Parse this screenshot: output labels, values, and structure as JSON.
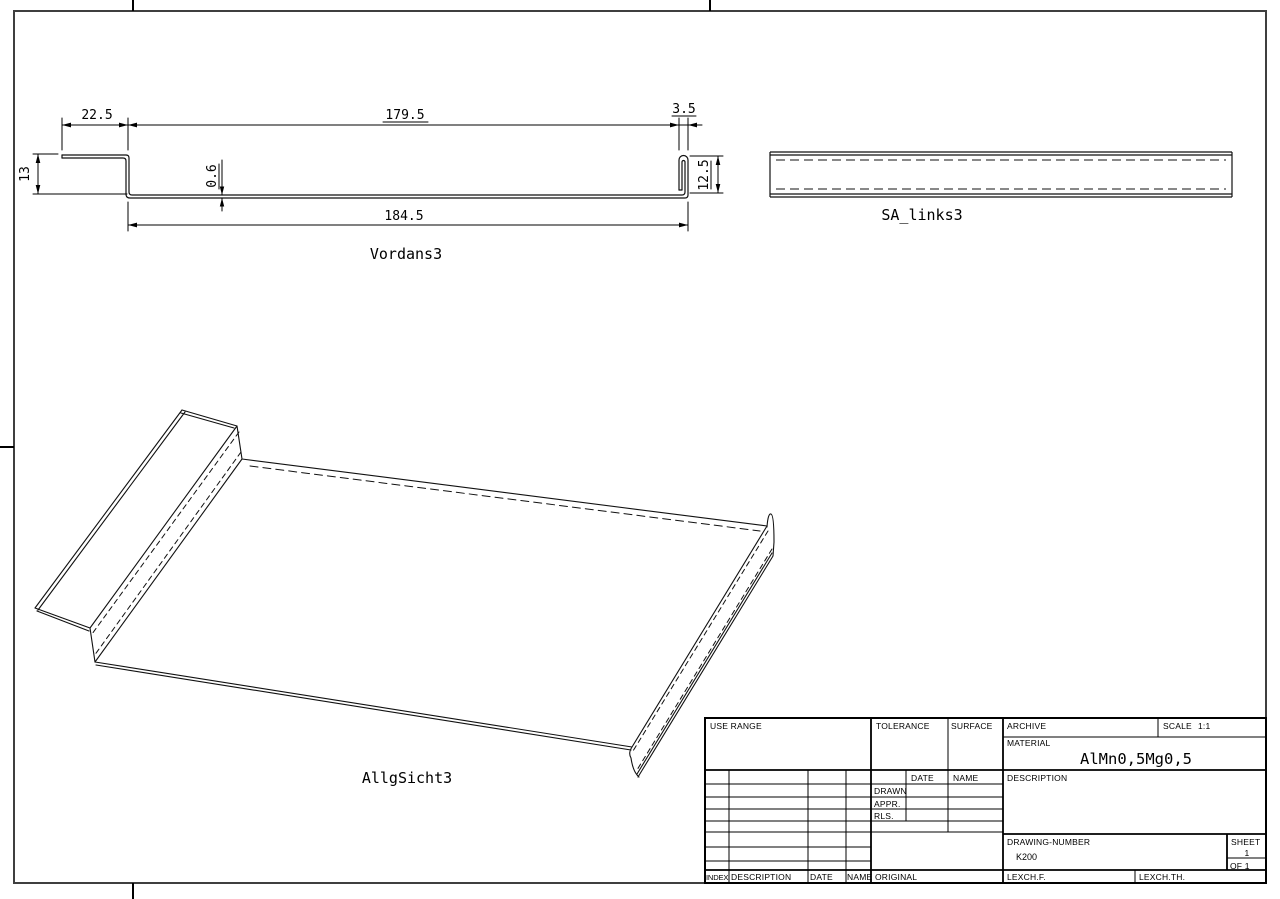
{
  "page": {
    "background": "#ffffff",
    "line_color": "#000000",
    "border_color": "#3f3f3f"
  },
  "views": {
    "front": {
      "label": "Vordans3",
      "dims": {
        "flange_width": "22.5",
        "top_length": "179.5",
        "hem_width": "3.5",
        "base_length": "184.5",
        "left_height": "13",
        "thickness": "0.6",
        "right_height": "12.5"
      }
    },
    "side": {
      "label": "SA_links3"
    },
    "iso": {
      "label": "AllgSicht3"
    }
  },
  "title_block": {
    "use_range": "USE RANGE",
    "tolerance": "TOLERANCE",
    "surface": "SURFACE",
    "archive": "ARCHIVE",
    "scale_label": "SCALE",
    "scale_value": "1:1",
    "material_label": "MATERIAL",
    "material_value": "AlMn0,5Mg0,5",
    "description": "DESCRIPTION",
    "date": "DATE",
    "name": "NAME",
    "drawn": "DRAWN",
    "appr": "APPR.",
    "rls": "RLS.",
    "drawing_number_label": "DRAWING-NUMBER",
    "drawing_number_value": "K200",
    "sheet_label": "SHEET",
    "sheet_value": "1",
    "of_value": "OF 1",
    "index": "INDEX",
    "description2": "DESCRIPTION",
    "date2": "DATE",
    "name2": "NAME",
    "original": "ORIGINAL",
    "iexchf": "LEXCH.F.",
    "iexchth": "LEXCH.TH."
  }
}
